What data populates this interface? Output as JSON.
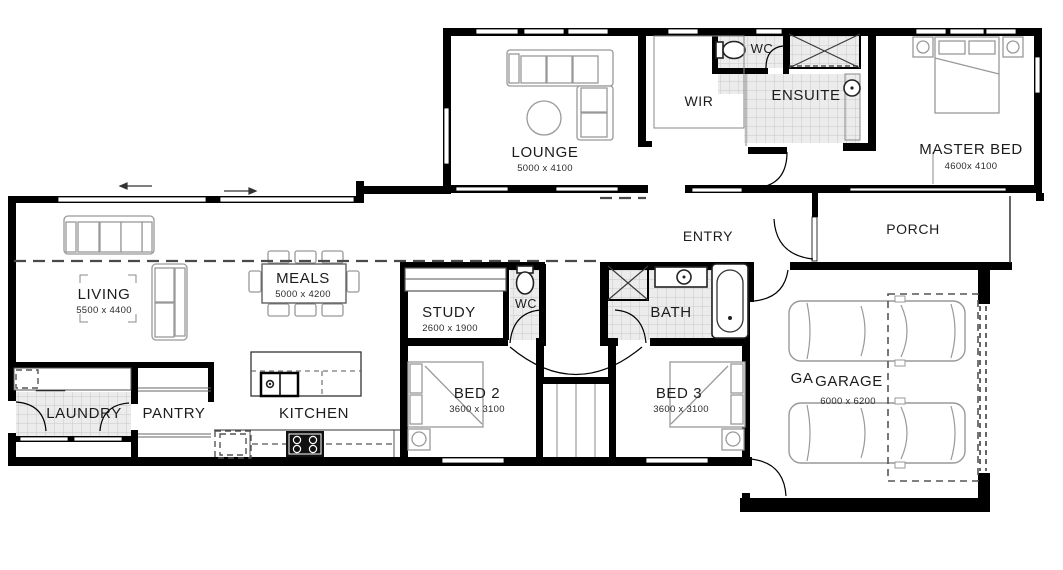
{
  "rooms": {
    "lounge": {
      "label": "LOUNGE",
      "dims": "5000 x 4100"
    },
    "wir": {
      "label": "WIR"
    },
    "wc_rear": {
      "label": "WC"
    },
    "ensuite": {
      "label": "ENSUITE"
    },
    "master_bed": {
      "label": "MASTER BED",
      "dims": "4600x 4100"
    },
    "entry": {
      "label": "ENTRY"
    },
    "porch": {
      "label": "PORCH"
    },
    "living": {
      "label": "LIVING",
      "dims": "5500 x 4400"
    },
    "meals": {
      "label": "MEALS",
      "dims": "5000 x 4200"
    },
    "study": {
      "label": "STUDY",
      "dims": "2600 x 1900"
    },
    "wc_mid": {
      "label": "WC"
    },
    "bath": {
      "label": "BATH"
    },
    "laundry": {
      "label": "LAUNDRY"
    },
    "pantry": {
      "label": "PANTRY"
    },
    "kitchen": {
      "label": "KITCHEN"
    },
    "bed2": {
      "label": "BED 2",
      "dims": "3600 x 3100"
    },
    "bed3": {
      "label": "BED 3",
      "dims": "3600 x 3100"
    },
    "garage": {
      "ghost": "GA",
      "label": "GARAGE",
      "dims": "6000 x 6200"
    }
  },
  "colors": {
    "wall": "#000000",
    "tile": "#ececec",
    "tile_grid": "#c9c9c9",
    "furniture": "#999999",
    "text": "#1c1c1c",
    "paper": "#ffffff"
  }
}
